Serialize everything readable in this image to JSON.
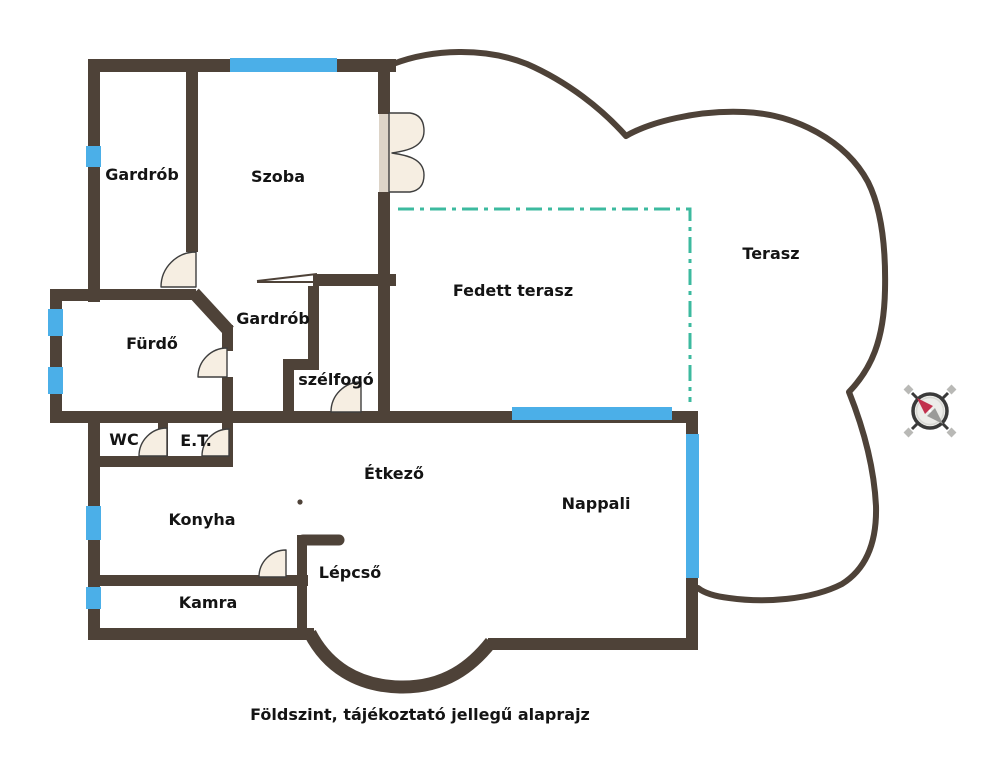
{
  "caption": "Földszint, tájékoztató jellegű alaprajz",
  "rooms": [
    {
      "label": "Gardrób"
    },
    {
      "label": "Szoba"
    },
    {
      "label": "Fürdő"
    },
    {
      "label": "Gardrób"
    },
    {
      "label": "szélfogó"
    },
    {
      "label": "Fedett terasz"
    },
    {
      "label": "Terasz"
    },
    {
      "label": "WC"
    },
    {
      "label": "E.T."
    },
    {
      "label": "Étkező"
    },
    {
      "label": "Konyha"
    },
    {
      "label": "Nappali"
    },
    {
      "label": "Lépcső"
    },
    {
      "label": "Kamra"
    }
  ],
  "colors": {
    "wall": "#4E4238",
    "window": "#4BAFE8",
    "terrace_boundary": "#3CBA9F",
    "door_fill": "#F6EEE2",
    "background": "#FFFFFF",
    "text": "#141414",
    "compass_north_needle": "#C2314E",
    "compass_south_needle": "#9A9A98"
  },
  "icons": {
    "compass": "compass-rose"
  }
}
